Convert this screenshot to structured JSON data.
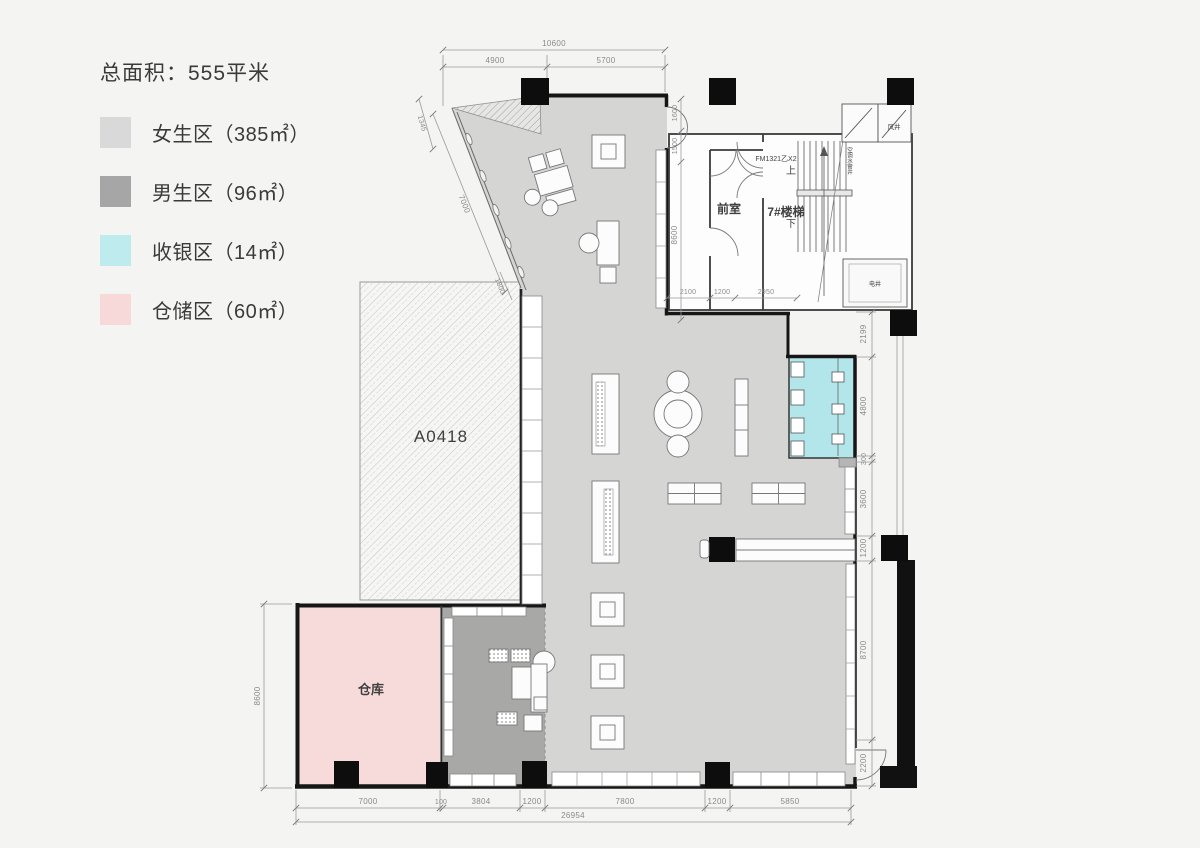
{
  "legend": {
    "title": "总面积：555平米",
    "items": [
      {
        "label": "女生区（385㎡）",
        "color": "#d9d9d9"
      },
      {
        "label": "男生区（96㎡）",
        "color": "#a6a6a6"
      },
      {
        "label": "收银区（14㎡）",
        "color": "#bdebee"
      },
      {
        "label": "仓储区（60㎡）",
        "color": "#f8d9d9"
      }
    ]
  },
  "plan": {
    "colors": {
      "women": "#d5d5d4",
      "men": "#a8a8a7",
      "cashier": "#b2e6eb",
      "storage": "#f7dbda"
    },
    "labels": {
      "unit": "A0418",
      "warehouse": "仓库",
      "front_room": "前室",
      "stair": "7#楼梯",
      "fire_door": "FM1321乙X2",
      "up": "上",
      "down": "下",
      "wind_shaft": "风井",
      "shaft": "电井",
      "pipe_shaft": "空调水管井"
    },
    "dims": {
      "top_total": "10600",
      "top_left": "4900",
      "top_right": "5700",
      "diag_small": "1345",
      "diag_main": "7000",
      "diag_end": "1800",
      "left_height": "8600",
      "core_height": "8600",
      "door_top": "1600",
      "door_bottom": "1500",
      "core_bottom": [
        "2100",
        "1200",
        "2950"
      ],
      "right_chain": [
        "2199",
        "4800",
        "300",
        "3600",
        "1200",
        "8700",
        "2200"
      ],
      "bottom_chain": [
        "7000",
        "100",
        "3804",
        "1200",
        "7800",
        "1200",
        "5850"
      ],
      "bottom_total": "26954"
    }
  }
}
